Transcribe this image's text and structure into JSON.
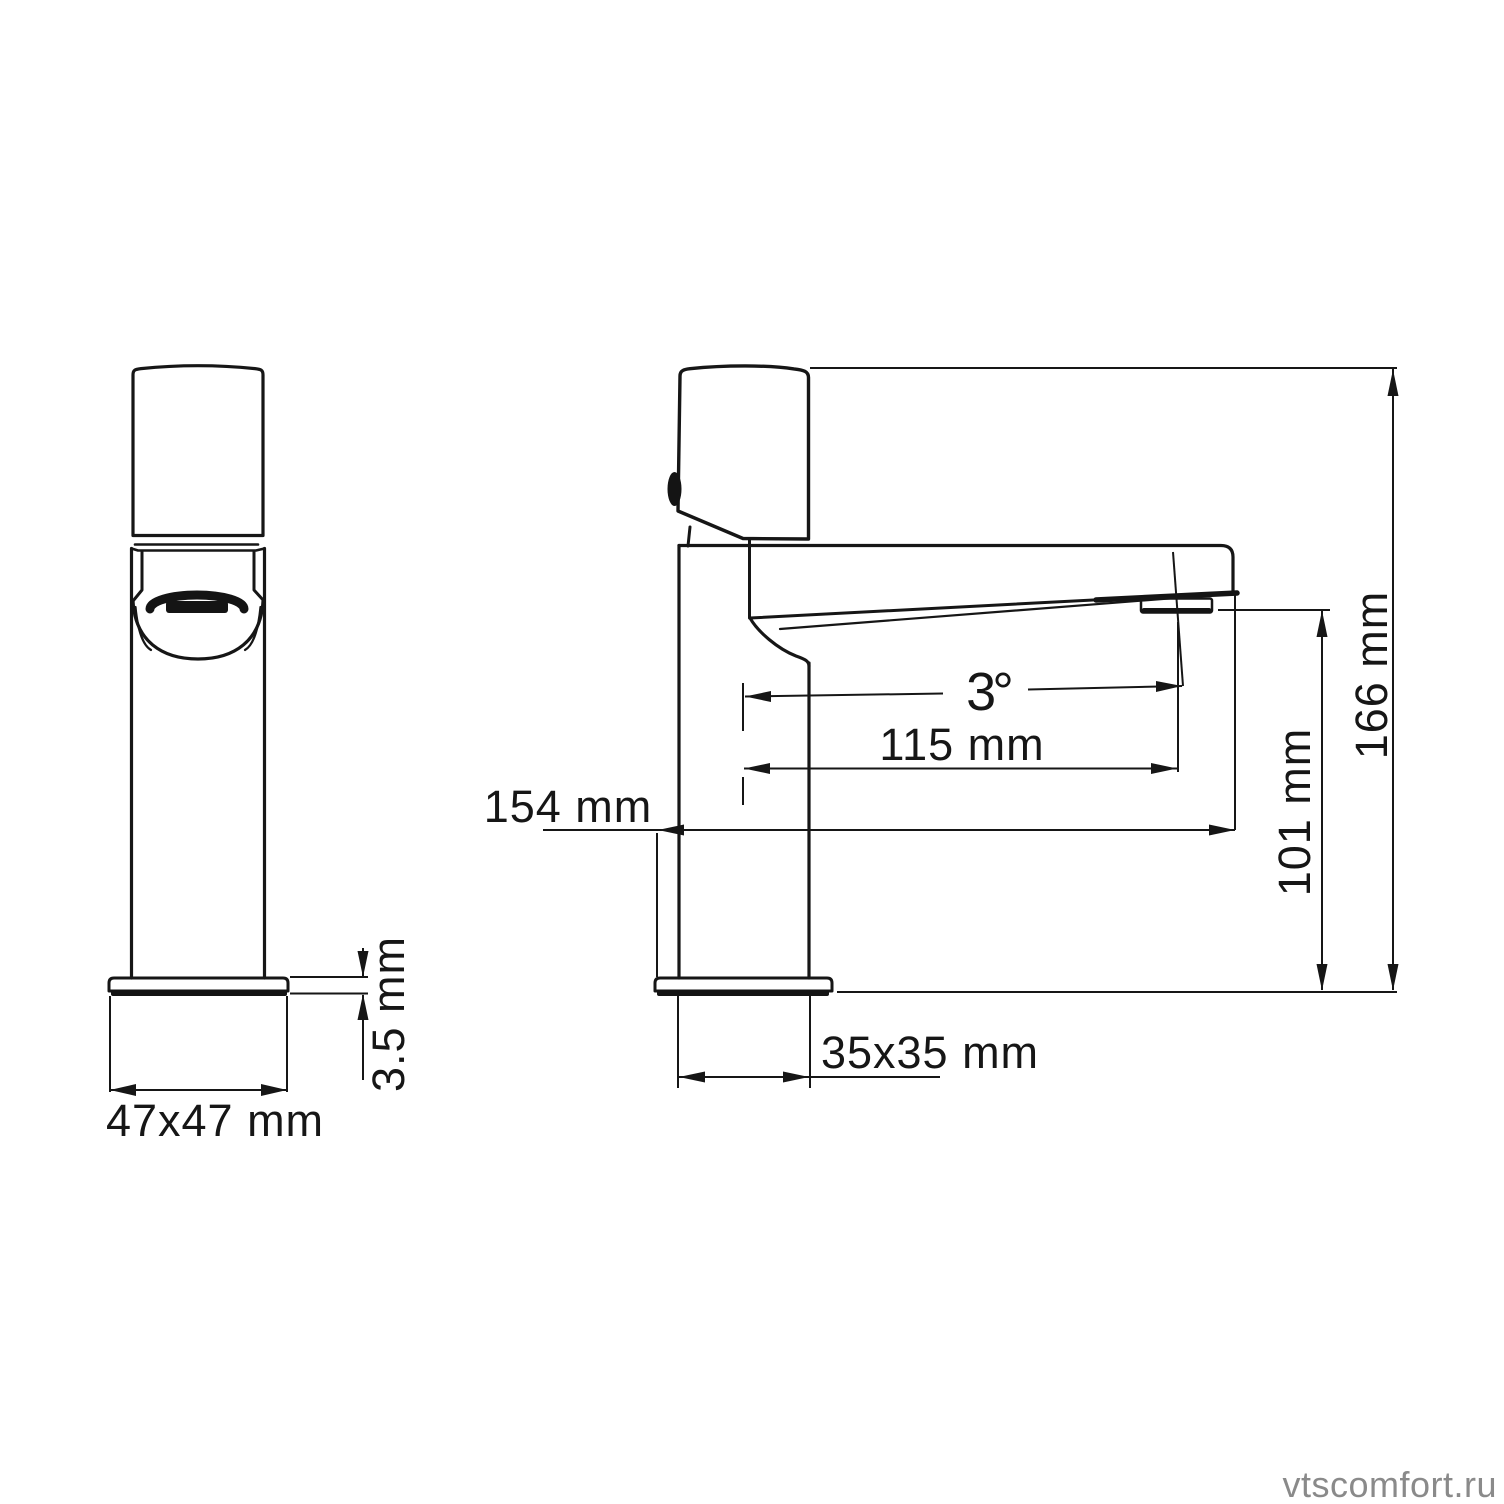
{
  "diagram": {
    "type": "technical-drawing",
    "subject": "basin faucet two-view dimension drawing",
    "watermark": "vtscomfort.ru",
    "dims": {
      "base_front": "47x47 mm",
      "plate_thickness": "3.5 mm",
      "reach_total": "154 mm",
      "reach_spout": "115 mm",
      "spout_angle": "3°",
      "outlet_height": "101 mm",
      "total_height": "166 mm",
      "base_side": "35x35 mm"
    },
    "colors": {
      "line": "#161616",
      "watermark": "#8a8a8a",
      "background": "#ffffff"
    }
  }
}
